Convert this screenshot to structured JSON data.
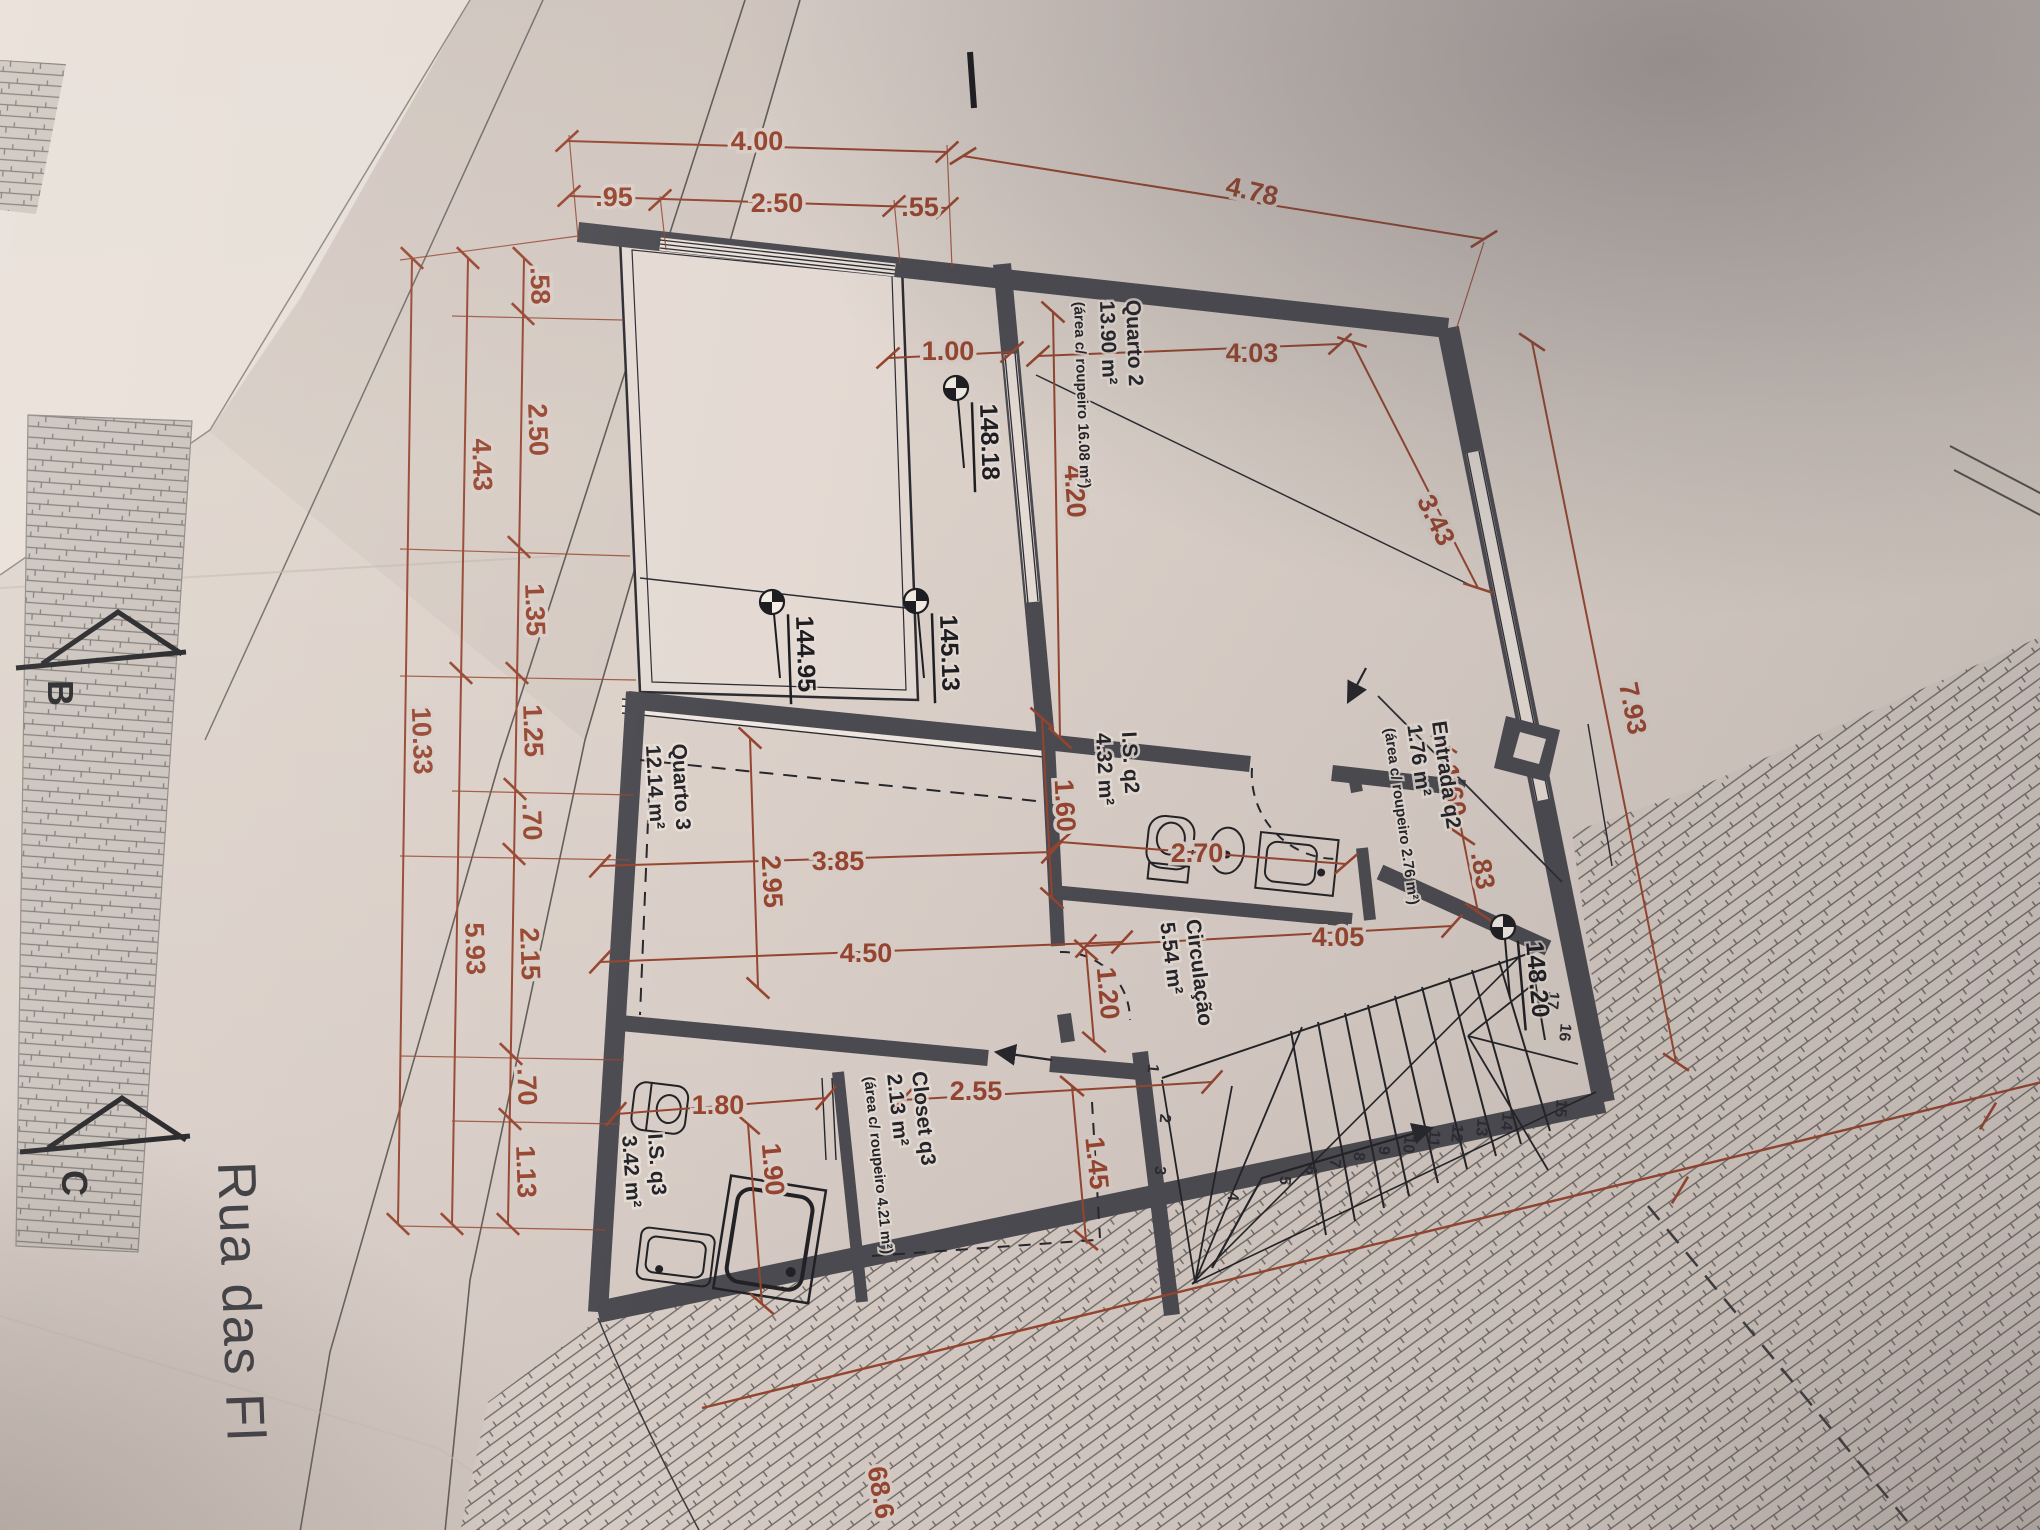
{
  "colors": {
    "paper": "#d9cec7",
    "dim": "#96452f",
    "wall": "#4a4a50",
    "ink": "#26262b"
  },
  "street": {
    "name": "Rua das Fl"
  },
  "sections": {
    "b": "B",
    "c": "C"
  },
  "levels": {
    "l1": "148.18",
    "l2": "144.95",
    "l3": "145.13",
    "l4": "148.20"
  },
  "rooms": {
    "quarto2": {
      "name": "Quarto 2",
      "area": "13.90 m²",
      "note": "(área c/ roupeiro 16.08 m²)"
    },
    "entrada": {
      "name": "Entrada q2",
      "area": "1.76 m²",
      "note": "(área c/ roupeiro 2.76 m²)"
    },
    "isq2": {
      "name": "I.S. q2",
      "area": "4.32 m²"
    },
    "quarto3": {
      "name": "Quarto 3",
      "area": "12.14 m²"
    },
    "circulacao": {
      "name": "Circulação",
      "area": "5.54 m²"
    },
    "closet": {
      "name": "Closet q3",
      "area": "2.13 m²",
      "note": "(área c/ roupeiro 4.21 m²)"
    },
    "isq3": {
      "name": "I.S. q3",
      "area": "3.42 m²"
    }
  },
  "dims": {
    "top1": "4.00",
    "top2": ".95",
    "top3": "2.50",
    "top4": ".55",
    "top5": "4.78",
    "left1": ".58",
    "left2": "2.50",
    "left3": "1.35",
    "left4": "1.25",
    "left5": ".70",
    "left6": "2.15",
    "left7": ".70",
    "left8": "1.13",
    "left9": "4.43",
    "left10": "5.93",
    "left11": "10.33",
    "q2a": "1.00",
    "q2b": "4.03",
    "q2c": "4.20",
    "q2d": "3.43",
    "ent1": "1.60",
    "ent2": ".83",
    "is2a": "1.60",
    "is2b": "2.70",
    "q3a": "3.85",
    "q3b": "2.95",
    "q3c": "4.50",
    "cor1": "4.05",
    "cor2": "1.20",
    "clo1": "2.55",
    "clo2": "1.45",
    "is3a": "1.80",
    "is3b": "1.90",
    "right1": "7.93",
    "bnd": "68.6"
  },
  "stairs": {
    "t1": "1",
    "t2": "2",
    "t3": "3",
    "t4": "4",
    "t5": "5",
    "t6": "6",
    "t7": "7",
    "t8": "8",
    "t9": "9",
    "t10": "10",
    "t11": "11",
    "t12": "12",
    "t13": "13",
    "t14": "14",
    "t15": "15",
    "t16": "16",
    "t17": "17"
  }
}
